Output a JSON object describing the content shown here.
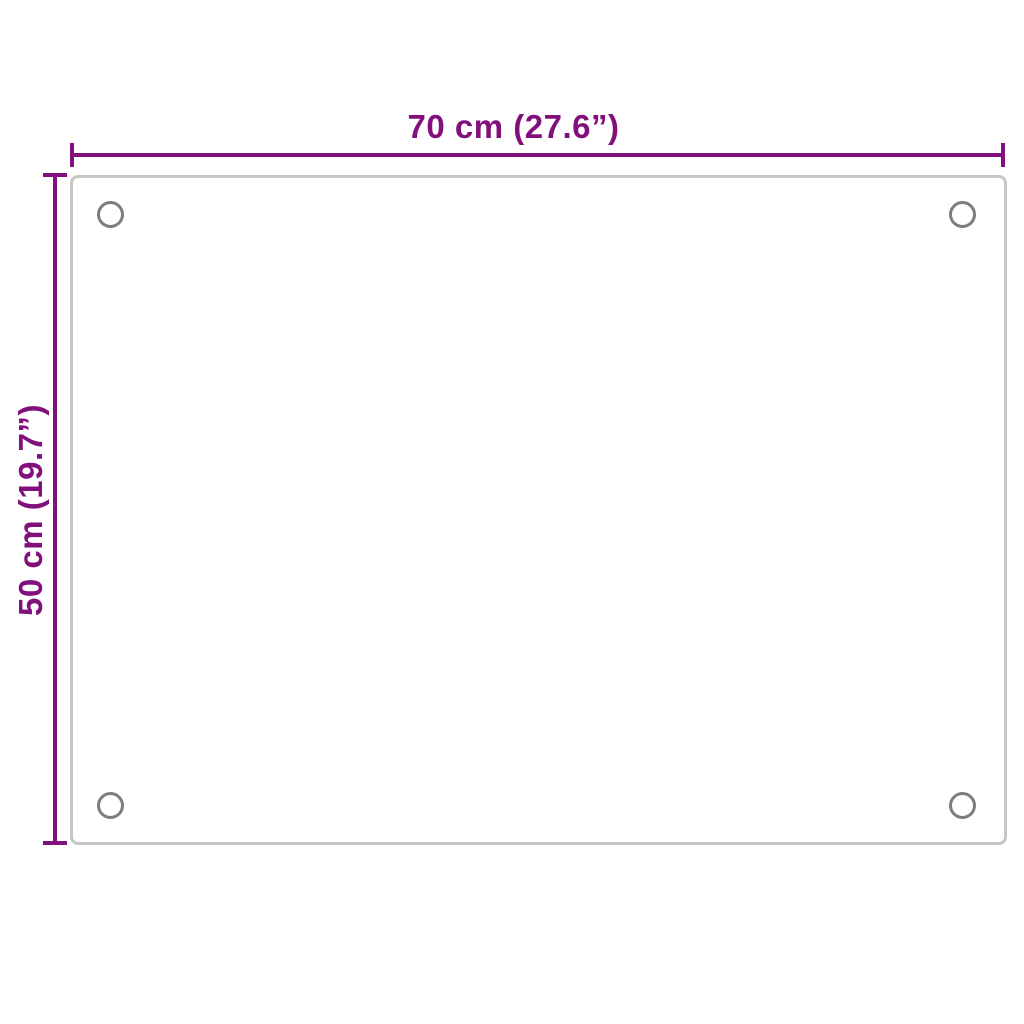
{
  "diagram": {
    "width_dimension": {
      "label": "70 cm (27.6”)"
    },
    "height_dimension": {
      "label": "50 cm (19.7”)"
    }
  },
  "colors": {
    "dimension": "#82107c",
    "panel_border": "#c6c6c6",
    "hole_stroke": "#7d7d7d",
    "background": "#ffffff"
  }
}
